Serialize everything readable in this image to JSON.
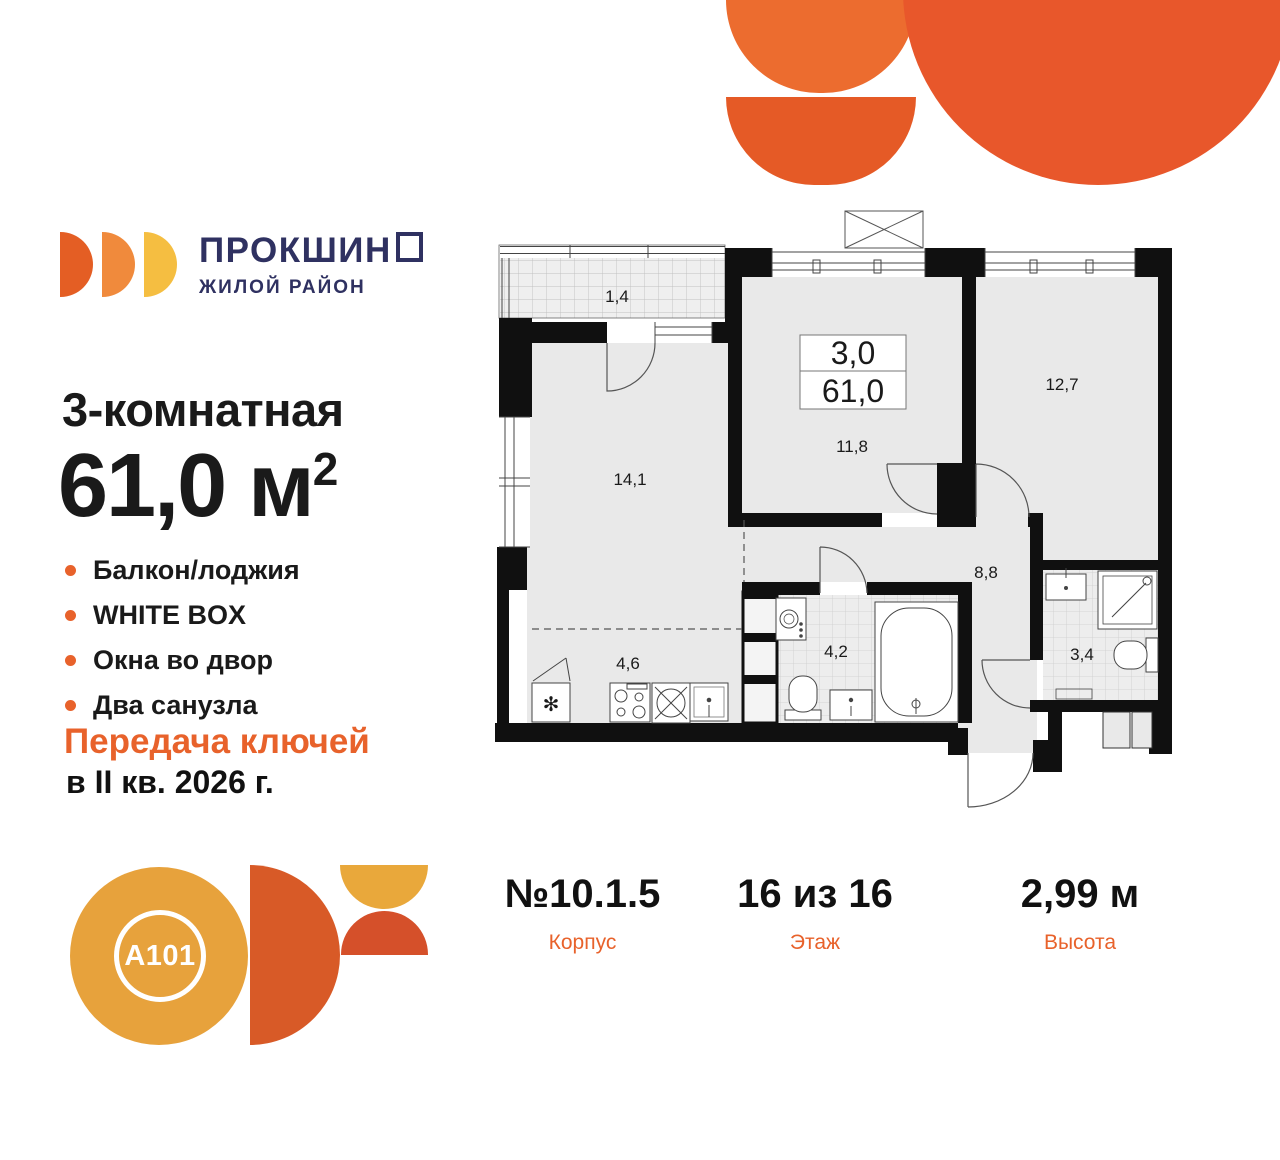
{
  "brand": {
    "title": "ПРОКШИНО",
    "title_main": "ПРОКШИН",
    "title_last_letter": "О",
    "subtitle": "ЖИЛОЙ РАЙОН"
  },
  "listing": {
    "rooms_title": "3-комнатная",
    "area_value": "61,0 м",
    "area_sup": "2",
    "features": [
      "Балкон/лоджия",
      "WHITE BOX",
      "Окна во двор",
      "Два санузла"
    ],
    "handover_line1": "Передача ключей",
    "handover_line2": "в II кв. 2026 г."
  },
  "stats": [
    {
      "value": "№10.1.5",
      "label": "Корпус"
    },
    {
      "value": "16 из 16",
      "label": "Этаж"
    },
    {
      "value": "2,99 м",
      "label": "Высота"
    }
  ],
  "floorplan": {
    "info_box": {
      "rooms": "3,0",
      "area": "61,0"
    },
    "rooms": {
      "balcony": "1,4",
      "living": "14,1",
      "bedroom1": "11,8",
      "bedroom2": "12,7",
      "hallway": "8,8",
      "kitchen": "4,6",
      "bathroom1": "4,2",
      "bathroom2": "3,4"
    }
  },
  "developer": {
    "logo_text": "A101"
  },
  "colors": {
    "accent_orange": "#E8622B",
    "brand_navy": "#2F3161",
    "deco_orange": "#E8572B",
    "a101_yellow": "#E7A23C",
    "a101_orange": "#D85A27",
    "wall_black": "#101010",
    "room_fill": "#E9E9E9"
  }
}
